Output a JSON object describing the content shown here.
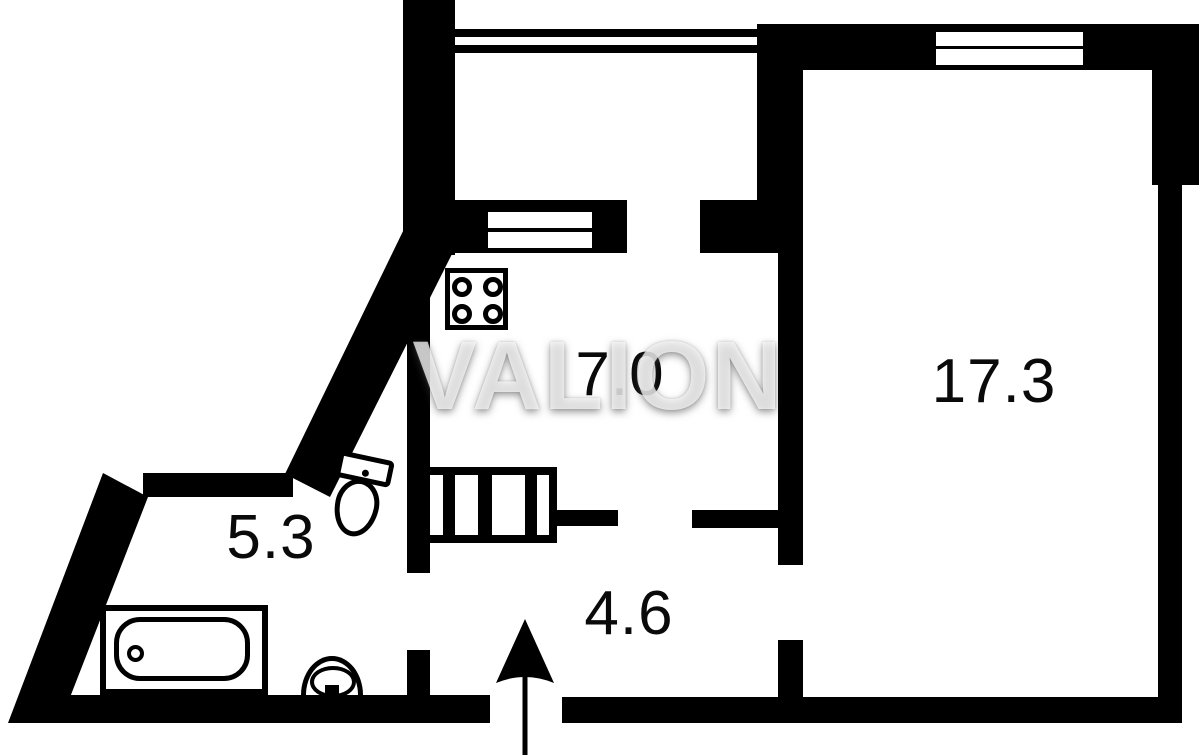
{
  "plan": {
    "watermark": "VALION",
    "rooms": {
      "kitchen": {
        "area": "7.0"
      },
      "living_room": {
        "area": "17.3"
      },
      "bathroom": {
        "area": "5.3"
      },
      "hallway": {
        "area": "4.6"
      }
    },
    "icons": {
      "stove": "stove-icon",
      "toilet": "toilet-icon",
      "bathtub": "bathtub-icon",
      "sink": "sink-icon",
      "vent": "ventilation-shaft-icon",
      "entrance": "entrance-arrow-icon",
      "windows": "window-icon"
    },
    "colors": {
      "wall": "#000000",
      "background": "#ffffff",
      "label": "#0a0a0a",
      "watermark_fill": "#f0f0f0"
    }
  }
}
